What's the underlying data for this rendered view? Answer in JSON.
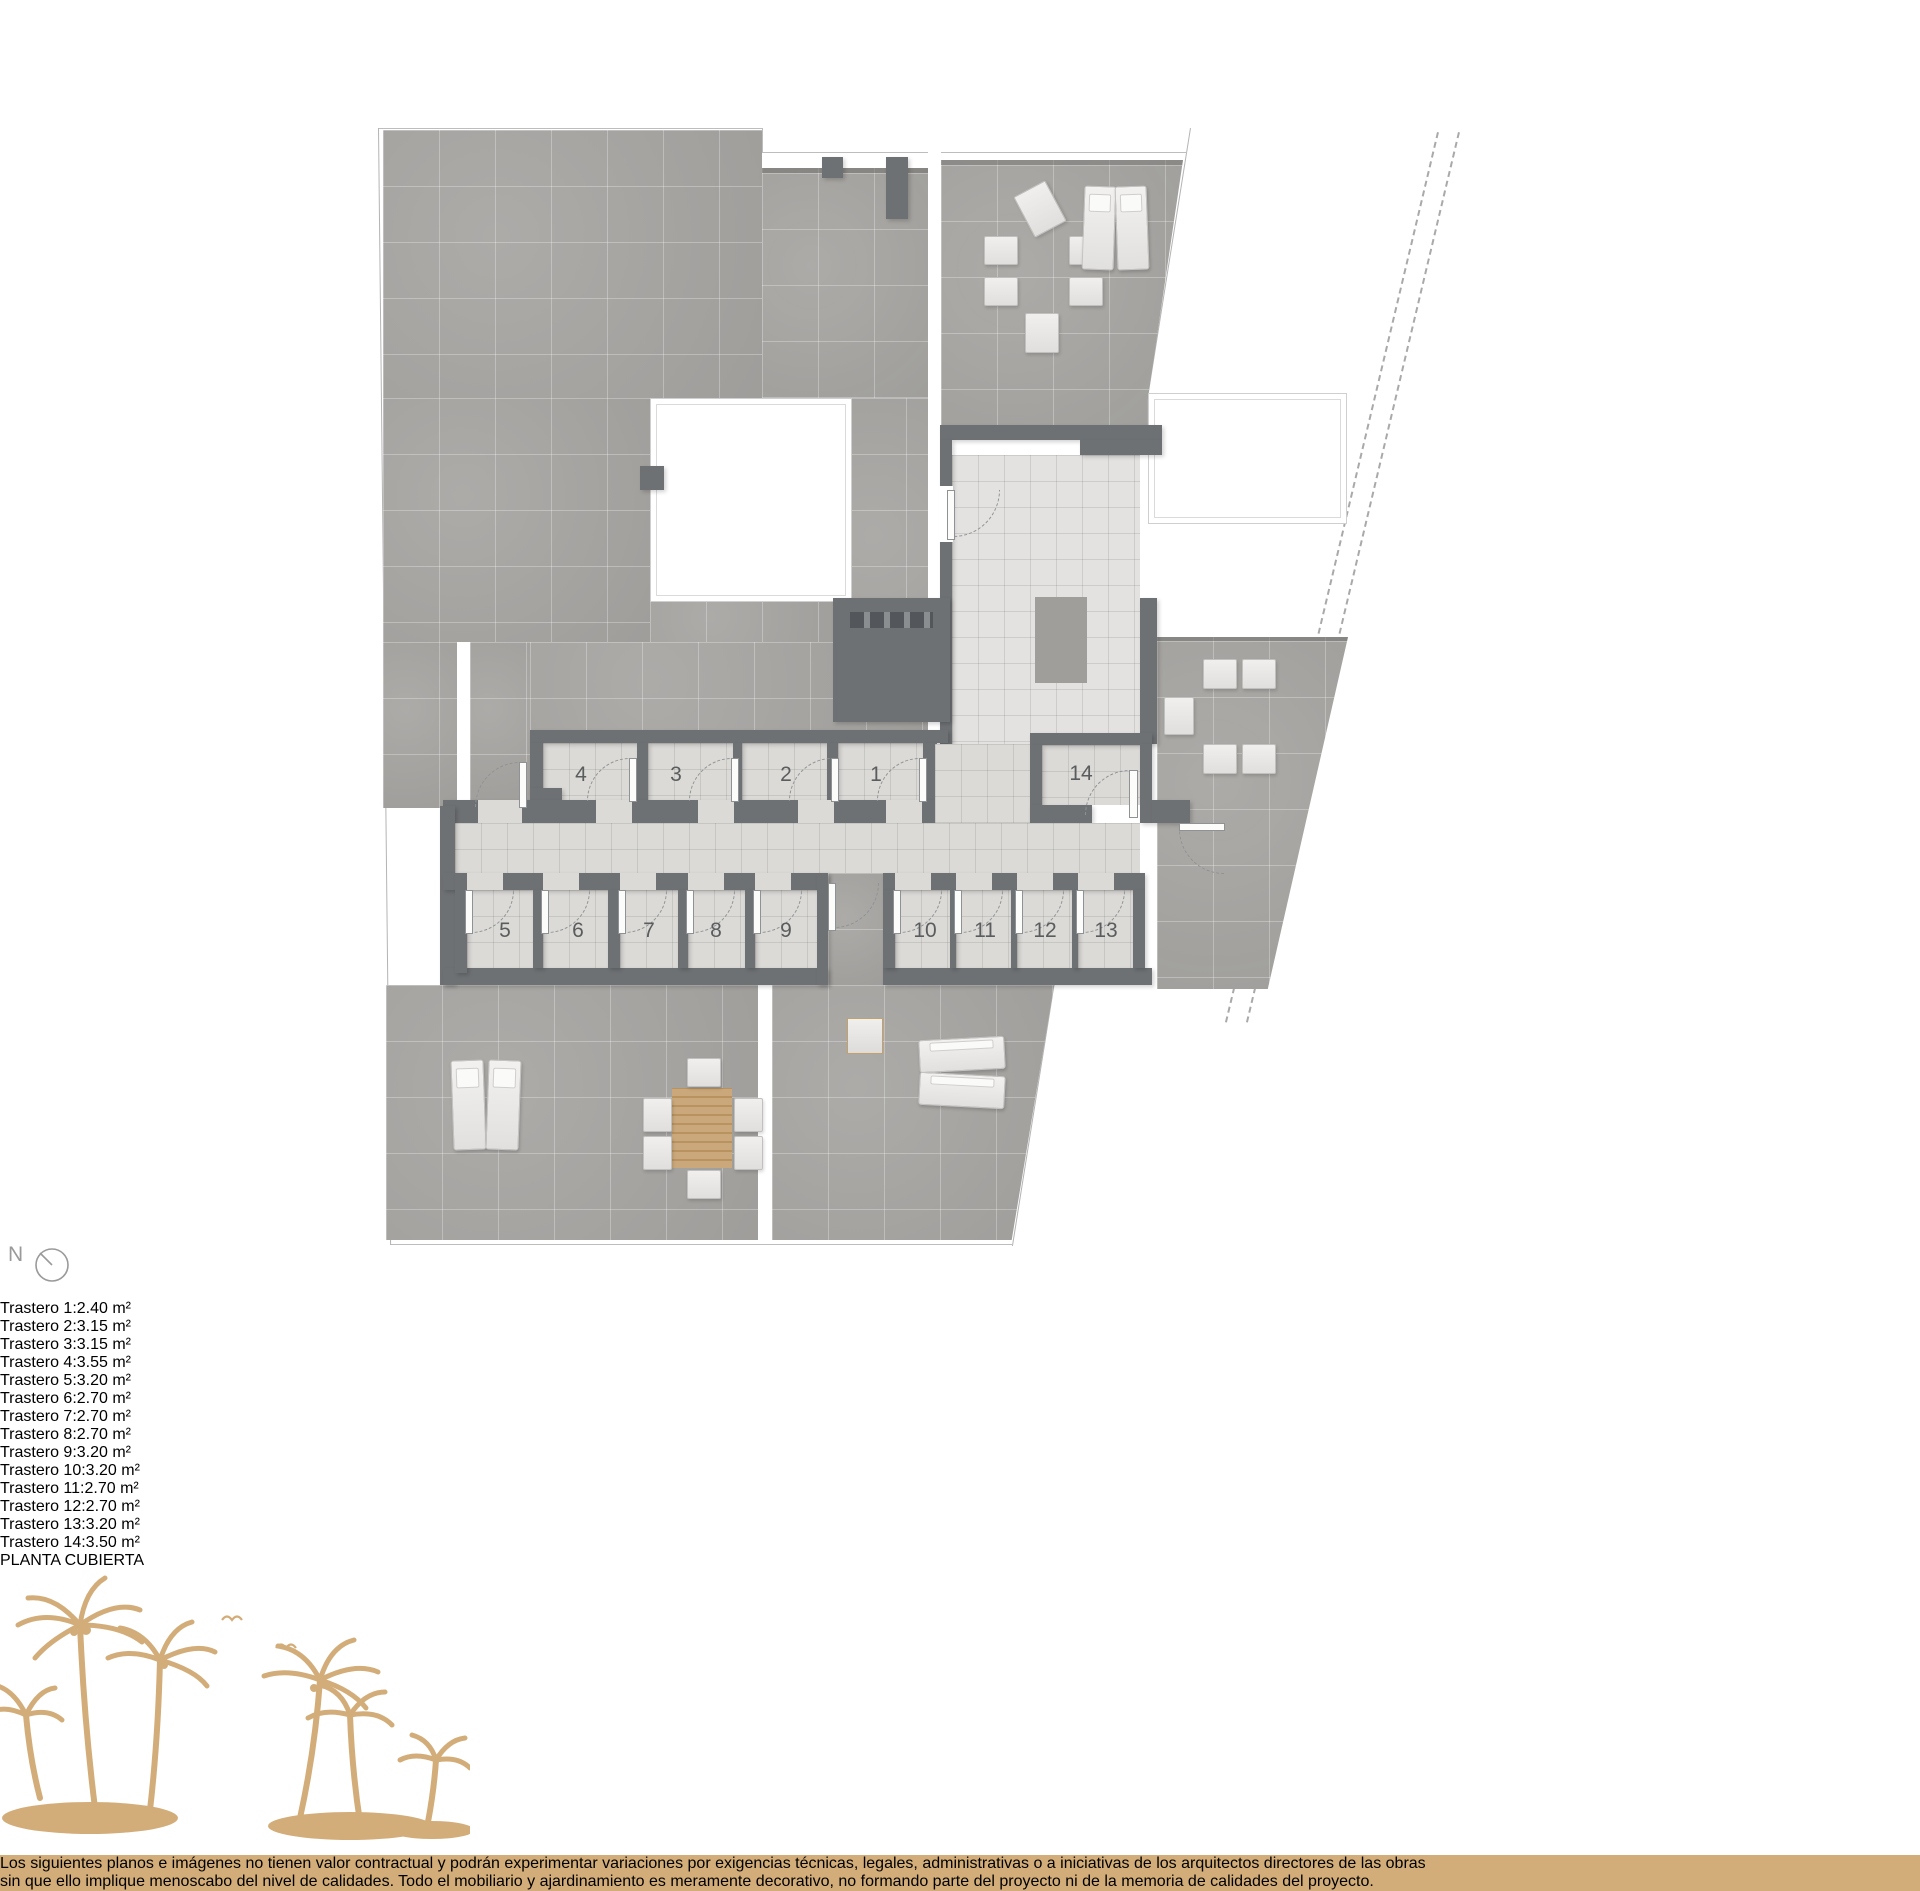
{
  "plan": {
    "title": "PLANTA CUBIERTA",
    "north_label": "N",
    "rooms": [
      {
        "number": "1"
      },
      {
        "number": "2"
      },
      {
        "number": "3"
      },
      {
        "number": "4"
      },
      {
        "number": "5"
      },
      {
        "number": "6"
      },
      {
        "number": "7"
      },
      {
        "number": "8"
      },
      {
        "number": "9"
      },
      {
        "number": "10"
      },
      {
        "number": "11"
      },
      {
        "number": "12"
      },
      {
        "number": "13"
      },
      {
        "number": "14"
      }
    ]
  },
  "legend": {
    "rows": [
      {
        "label": "Trastero 1:",
        "area": "2.40 m²"
      },
      {
        "label": "Trastero 2:",
        "area": "3.15 m²"
      },
      {
        "label": "Trastero 3:",
        "area": "3.15 m²"
      },
      {
        "label": "Trastero 4:",
        "area": "3.55 m²"
      },
      {
        "label": "Trastero 5:",
        "area": "3.20 m²"
      },
      {
        "label": "Trastero 6:",
        "area": "2.70 m²"
      },
      {
        "label": "Trastero 7:",
        "area": "2.70 m²"
      },
      {
        "label": "Trastero 8:",
        "area": "2.70 m²"
      },
      {
        "label": "Trastero 9:",
        "area": "3.20 m²"
      },
      {
        "label": "Trastero 10:",
        "area": "3.20 m²"
      },
      {
        "label": "Trastero 11:",
        "area": "2.70 m²"
      },
      {
        "label": "Trastero 12:",
        "area": "2.70 m²"
      },
      {
        "label": "Trastero 13:",
        "area": "3.20 m²"
      },
      {
        "label": "Trastero 14:",
        "area": "3.50 m²"
      }
    ]
  },
  "footer": {
    "line1": "Los siguientes planos e imágenes no tienen valor contractual y podrán experimentar variaciones por exigencias técnicas, legales, administrativas o a iniciativas de los arquitectos directores de las obras",
    "line2": "sin que ello implique menoscabo del nivel de calidades. Todo el mobiliario y ajardinamiento es meramente decorativo, no formando parte del proyecto ni de la memoria de calidades del proyecto."
  },
  "colors": {
    "accent_tan": "#d3ad79",
    "wall_gray": "#6e7174",
    "terrace_tile": "#a8a6a3",
    "interior_floor": "#dbdad7",
    "legend_text": "#525456"
  }
}
